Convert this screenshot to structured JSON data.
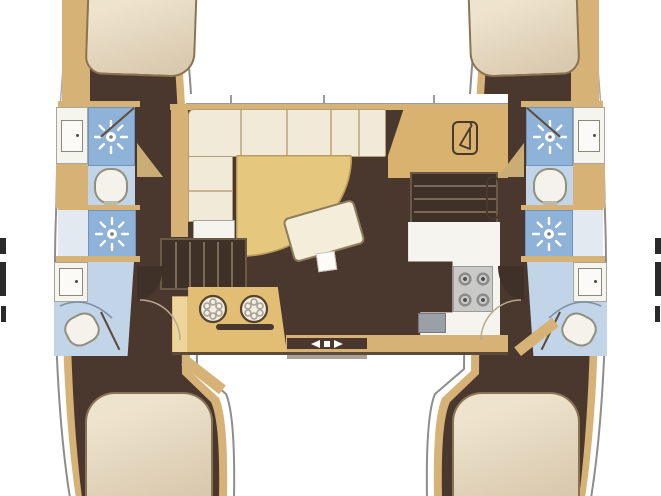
{
  "plan": {
    "type": "catamaran-interior-floor-plan",
    "orientation": "bow-up",
    "hull_count": 2,
    "cabin_count": 4,
    "bathroom_count": 4,
    "shower_stall_count": 2,
    "features": [
      "port-forward-cabin-double-berth",
      "port-forward-bathroom-with-sink-toilet-shower",
      "port-midship-shower-stall",
      "port-aft-bathroom-with-sink-toilet",
      "port-aft-cabin-double-berth",
      "starboard-forward-cabin-double-berth",
      "starboard-forward-bathroom-with-sink-toilet-shower",
      "starboard-midship-shower-stall",
      "starboard-aft-bathroom-with-sink-toilet",
      "starboard-aft-cabin-double-berth",
      "saloon-l-shaped-sofa",
      "saloon-curved-table",
      "saloon-ottoman",
      "nav-station-with-hanging-locker",
      "galley-double-round-sink-unit",
      "galley-counter-with-four-burner-stove",
      "galley-appliance",
      "port-companionway-stairs",
      "starboard-companionway-stairs",
      "aft-cockpit-entry-door-arrows"
    ],
    "icons": [
      "shower-sunburst-icon",
      "toilet-icon",
      "sink-icon",
      "double-round-sink-icon",
      "four-burner-stove-icon",
      "hanger-icon",
      "stairs-icon",
      "door-swing-icon",
      "entry-arrows-icon"
    ]
  },
  "palette": {
    "bg": "#ffffff",
    "hull-outline": "#8d8d8d",
    "wall-tan": "#d7b277",
    "wall-tan-light": "#ecd69e",
    "floor-dark": "#4a382e",
    "bed-cream": "#e6dac3",
    "bed-outline": "#8a7353",
    "sofa-cream": "#f1ead9",
    "table-tan": "#e6c77e",
    "bath-blue-light": "#c2d4e8",
    "bath-blue": "#8fb2d8",
    "fixture-white": "#f6f4ee",
    "stove-gray": "#c9c9c7",
    "appliance-gray": "#9aa0a6",
    "stair-dark": "#3f3128",
    "stair-line": "#7b6a58"
  }
}
